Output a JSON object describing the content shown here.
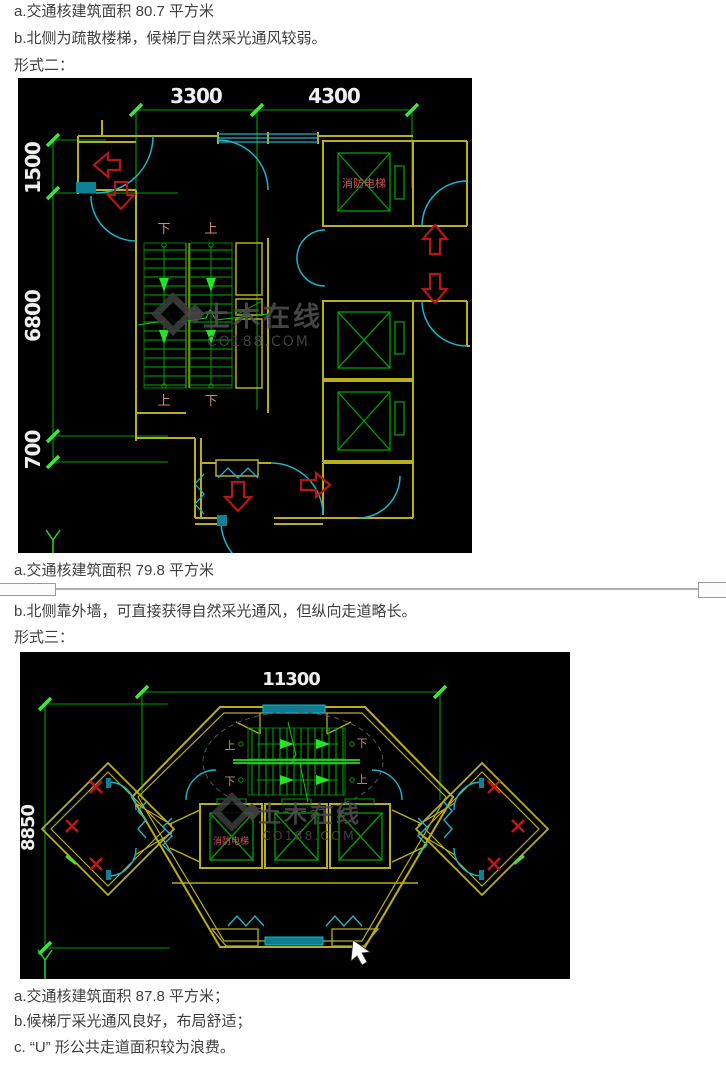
{
  "document": {
    "paragraphs": {
      "form1_area": "a.交通核建筑面积 80.7 平方米",
      "form1_note": "b.北侧为疏散楼梯，候梯厅自然采光通风较弱。",
      "form2_heading": "形式二：",
      "form2_area": "a.交通核建筑面积 79.8 平方米",
      "form2_note": "b.北侧靠外墙，可直接获得自然采光通风，但纵向走道略长。",
      "form3_heading": "形式三：",
      "form3_area": "a.交通核建筑面积 87.8 平方米；",
      "form3_note": "b.候梯厅采光通风良好，布局舒适；",
      "form3_note2": "c. “U” 形公共走道面积较为浪费。"
    },
    "drawing1": {
      "dimensions": {
        "top_left": "3300",
        "top_right": "4300",
        "left_top": "1500",
        "left_middle": "6800",
        "left_bottom": "700"
      },
      "labels": {
        "fire_elevator": "消防电梯",
        "stair_top_left": "下",
        "stair_top_right": "上",
        "stair_bottom_left": "上",
        "stair_bottom_right": "下"
      },
      "watermark": {
        "name": "土木在线",
        "site": "CO188.COM"
      }
    },
    "drawing2": {
      "dimensions": {
        "top": "11300",
        "left": "8850"
      },
      "labels": {
        "fire_elevator": "消防电梯",
        "stair_top_left": "上",
        "stair_top_right": "下",
        "stair_bottom_left": "下",
        "stair_bottom_right": "上"
      },
      "watermark": {
        "name": "土木在线",
        "site": "CO188.COM"
      }
    },
    "colors": {
      "background": "#000000",
      "wall": "#b9ae1c",
      "door": "#1ab5cd",
      "door_panel": "#0e8194",
      "dimension_line": "#00a000",
      "dimension_tick": "#39e639",
      "dimension_text": "#efefef",
      "arrow_red": "#b51616",
      "stair_label": "#d08a76",
      "fire_label": "#d05858",
      "watermark": "#4d4d4d",
      "page_text": "#3e3e3e"
    }
  }
}
